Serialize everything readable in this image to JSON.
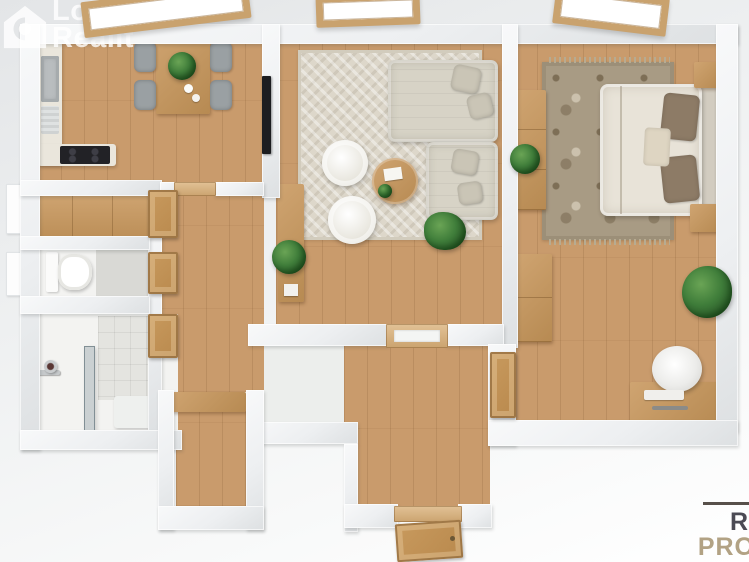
{
  "watermark": {
    "icon": "house-lens-logo-icon",
    "line1": "Lo",
    "line2": "Realit",
    "color": "#ffffff",
    "opacity": 0.8
  },
  "brand": {
    "line1": "R",
    "line2": "PRO",
    "line1_color": "#4b4a54",
    "line2_color": "#b2a284",
    "rule_color": "#57504a"
  },
  "palette": {
    "background": "#edeff0",
    "wall": "#eff1f2",
    "wall_edge": "#dde0e2",
    "wood_floor": "#c99b6c",
    "counter": "#eae6dc",
    "cooktop": "#26262a",
    "living_rug": "#ddd7ca",
    "bedroom_rug": "#a89b84",
    "sofa": "#d7d3c6",
    "bed_duvet": "#e8e3d8",
    "pillow_brown": "#8d7b66",
    "door_wood": "#c19150",
    "plant_green": "#3f7d3a",
    "tile": "#e4e4e0",
    "shower_glass": "#98a6ad"
  },
  "scene": {
    "type": "3d-floor-plan-top-view",
    "rooms": [
      "kitchen-dining",
      "living-room",
      "bedroom",
      "wc",
      "bathroom",
      "hallway",
      "entry-hall",
      "closet"
    ],
    "furniture": [
      "kitchen-counter",
      "sink",
      "cooktop",
      "dining-table",
      "dining-chairs",
      "living-rug",
      "corner-sofa",
      "poufs",
      "coffee-table",
      "tv",
      "sideboard",
      "plants",
      "bedroom-rug",
      "double-bed",
      "nightstands",
      "wardrobes",
      "desk",
      "desk-chair",
      "toilet",
      "shower-screen",
      "shower-mixer",
      "interior-doors",
      "entry-door",
      "windows"
    ]
  }
}
